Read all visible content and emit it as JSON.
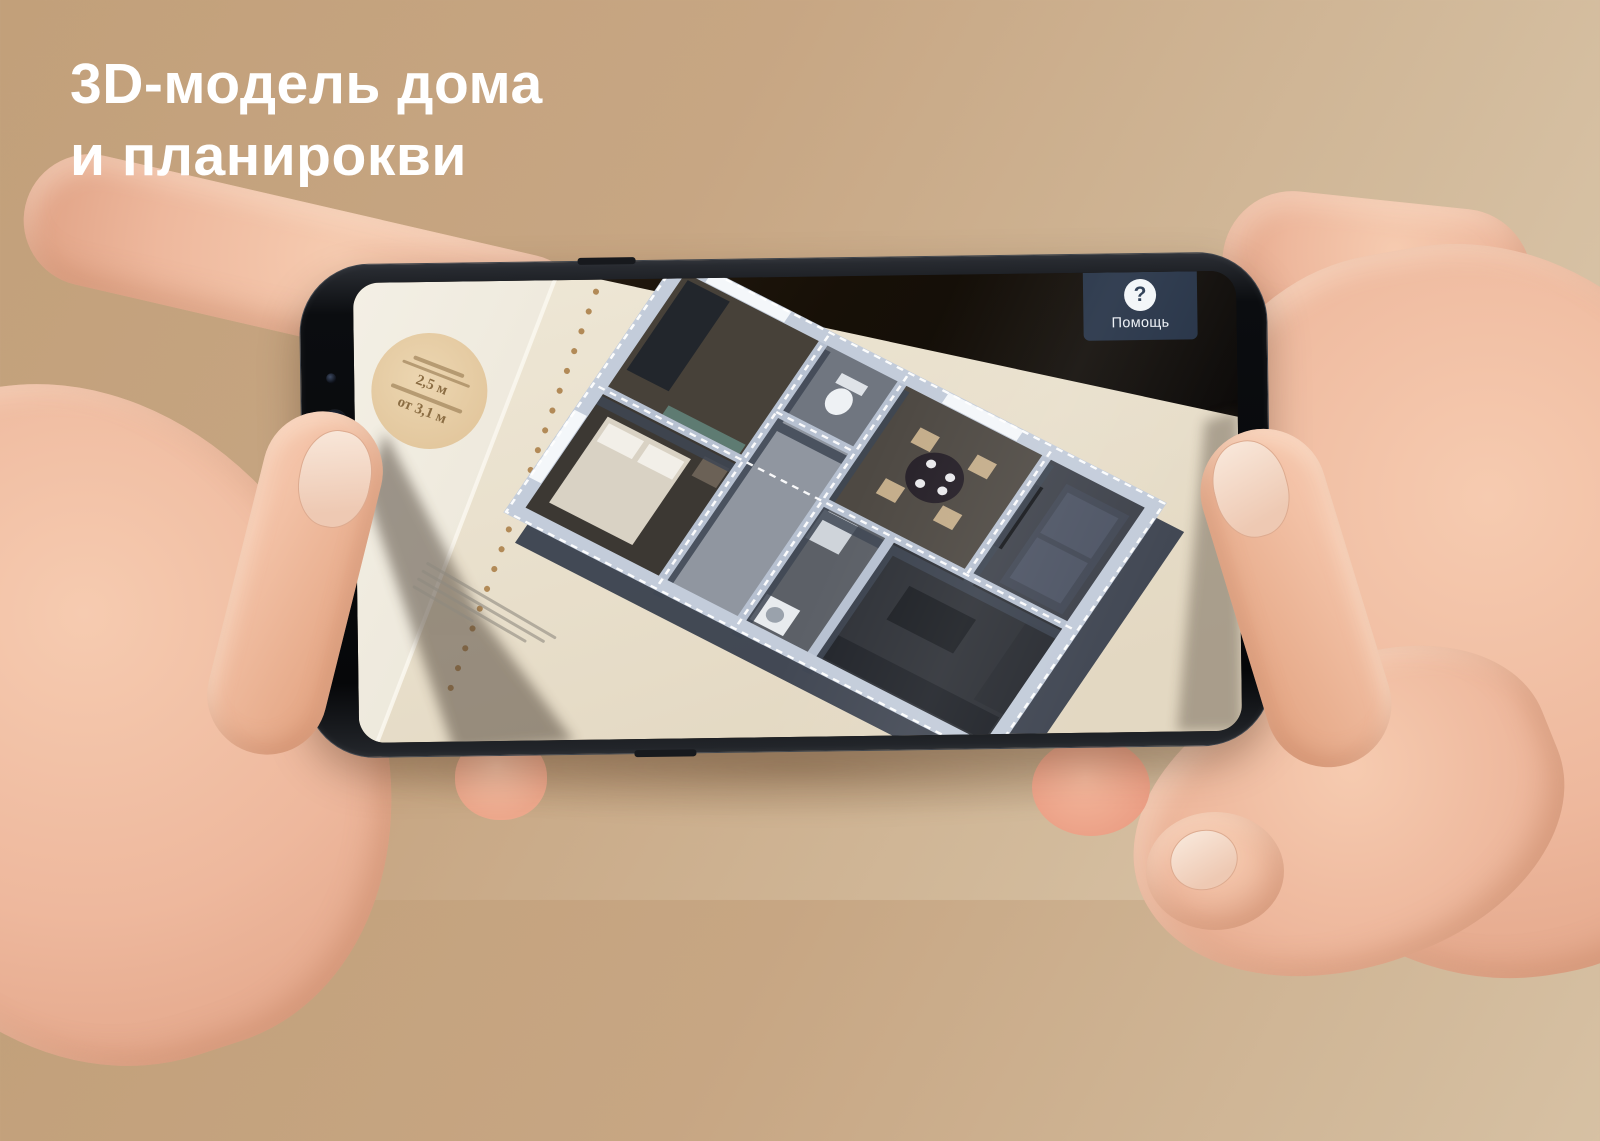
{
  "title": {
    "line1": "3D-модель дома",
    "line2": "и планирокви"
  },
  "phone": {
    "screen": {
      "help_button": {
        "label": "Помощь",
        "icon_glyph": "?"
      },
      "marker_badge": {
        "value_primary": "2,5 м",
        "value_secondary": "от 3,1 м"
      }
    }
  },
  "colors": {
    "background_start": "#c2a07a",
    "background_end": "#decbb0",
    "title_text": "#ffffff",
    "phone_body": "#0b0d10",
    "screen_dark_background": "#17110c",
    "paper_white": "#f5f1e8",
    "paper_cream": "#e9e0cc",
    "fold_dots": "#b28a57",
    "badge_fill": "#e7cfa8",
    "badge_text": "#8b6d43",
    "help_button_bg": "#293951",
    "help_button_text": "#edf1f6",
    "model_wall": "#b7c1d1",
    "model_wall_side": "#3e4654",
    "ar_outline_dash": "#ffffff",
    "hand_skin": "#eeb89d"
  }
}
